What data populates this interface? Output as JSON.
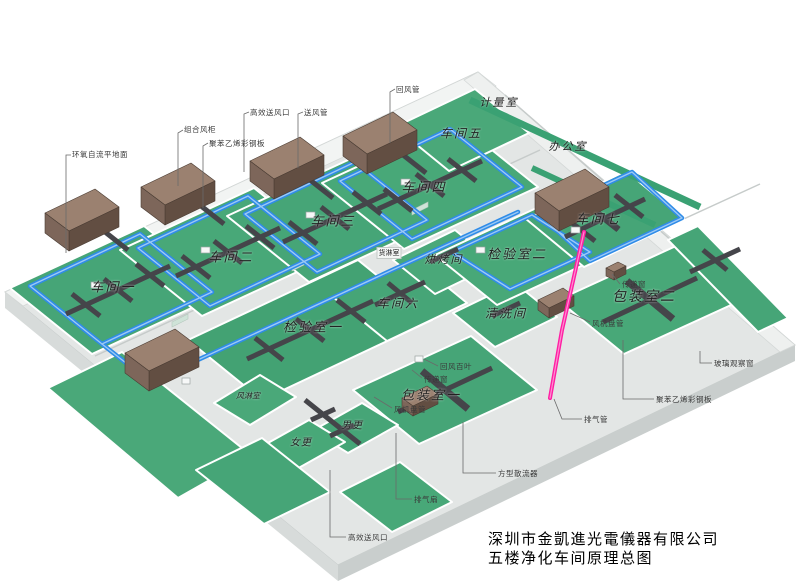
{
  "title": {
    "company": "深圳市金凱進光電儀器有限公司",
    "subtitle": "五楼净化车间原理总图"
  },
  "rooms": {
    "workshop1": "车间一",
    "workshop2": "车间二",
    "workshop3": "车间三",
    "workshop4": "车间四",
    "workshop5": "车间五",
    "workshop6": "车间六",
    "workshop7": "车间七",
    "metering_room": "计量室",
    "office": "办公室",
    "inspection1": "检验室一",
    "inspection2": "检验室二",
    "baking_room": "烘烤间",
    "cleaning_room": "清洗间",
    "packing1": "包装室一",
    "packing2": "包装室二",
    "cargo_shower": "货淋室",
    "air_shower": "风淋室",
    "male_changing": "男更",
    "female_changing": "女更"
  },
  "callouts": {
    "epoxy_floor": "环氧自流平地面",
    "ahu": "组合风柜",
    "steel_panel_top": "聚苯乙烯彩钢板",
    "hepa_outlet_top": "高效送风口",
    "supply_duct": "送风管",
    "return_duct": "回风管",
    "return_louver": "回风百叶",
    "pass_window_1": "传递窗",
    "fan_coil_1": "风机盘管",
    "pass_window_2": "传递窗",
    "fan_coil_2": "风机盘管",
    "glass_window": "玻璃观察窗",
    "steel_panel_right": "聚苯乙烯彩钢板",
    "exhaust_duct": "排气管",
    "square_diffuser": "方型散流器",
    "exhaust_fan": "排气扇",
    "hepa_outlet_bottom": "高效送风口"
  },
  "colors": {
    "floor_green": "#46a577",
    "supply_duct_blue": "#2f8ce8",
    "return_duct_dark": "#46464b",
    "ahu_brown": "#9b8170",
    "exhaust_pink": "#ff1fa3",
    "slab_gray": "#e3e6e5"
  }
}
